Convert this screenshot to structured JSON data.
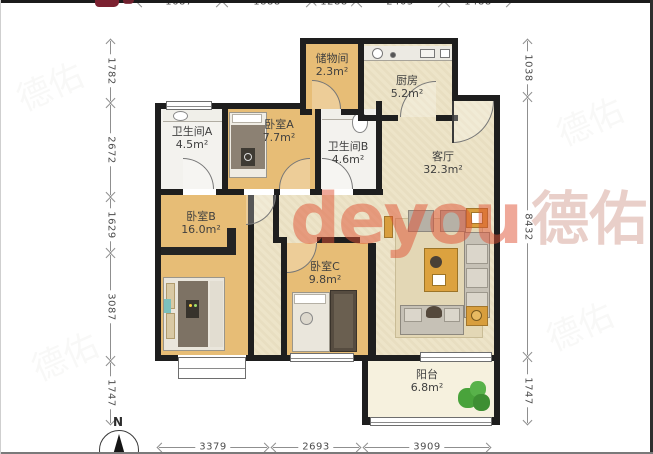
{
  "watermark": {
    "brand_latin": "deyou",
    "brand_cjk": "德佑"
  },
  "compass": {
    "north_label": "N"
  },
  "rooms": [
    {
      "name": "储物间",
      "area": "2.3m²"
    },
    {
      "name": "厨房",
      "area": "5.2m²"
    },
    {
      "name": "卫生间A",
      "area": "4.5m²"
    },
    {
      "name": "卧室A",
      "area": "7.7m²"
    },
    {
      "name": "卫生间B",
      "area": "4.6m²"
    },
    {
      "name": "客厅",
      "area": "32.3m²"
    },
    {
      "name": "卧室B",
      "area": "16.0m²"
    },
    {
      "name": "卧室C",
      "area": "9.8m²"
    },
    {
      "name": "阳台",
      "area": "6.8m²"
    }
  ],
  "dimensions": {
    "top": [
      "1687",
      "1888",
      "1288",
      "2403",
      "1488"
    ],
    "left": [
      "1782",
      "2672",
      "1629",
      "3087",
      "1747"
    ],
    "right": [
      "1038",
      "8432",
      "1747"
    ],
    "bottom": [
      "3379",
      "2693",
      "3909"
    ]
  },
  "colors": {
    "wall": "#1e1e1e",
    "wood_floor": "#e7bd76",
    "tile_floor": "#f3f2ee",
    "cream_floor": "#ece2c4",
    "balcony_floor": "#f6f1de",
    "watermark_accent": "#df5234",
    "plant_green": "#49a33b"
  }
}
